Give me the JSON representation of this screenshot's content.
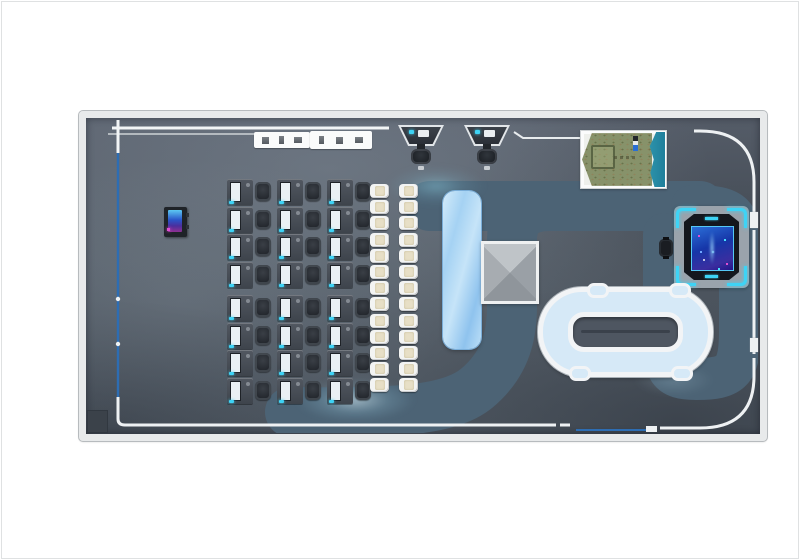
{
  "scene": {
    "title": "venue-floor-plan",
    "description": "Top-down 3D render of an e-sports / entertainment venue hall",
    "areas": {
      "workstation_zone": "rows of gaming desks with monitors and chairs",
      "seating_rows": "two columns of white chairs",
      "bar_counter": "light blue rounded counter",
      "pyramid_feature": "gray pyramid structure",
      "race_track": "white-edged mini racing track with center island",
      "game_table": "glowing interactive table on gray pad with cyan corner brackets",
      "terrain_model": "framed miniature terrain with grass field, pen and river",
      "kiosks": "two standing kiosks with stools near top wall",
      "walkway": "teal winding walkway path painted on floor"
    }
  },
  "inventory": {
    "desk_columns": 3,
    "desk_blocks_per_column": 2,
    "desks_per_block": 4,
    "total_desks": 24,
    "white_chair_columns": 2,
    "white_chairs_per_column": 13,
    "kiosk_count": 2,
    "shelf_count": 2,
    "door_tabs_right_wall": 2
  },
  "colors": {
    "wall": "#e8eaeb",
    "path": "#4c6375",
    "cyan": "#3ed3f5",
    "magenta": "#e14fd2",
    "glass": "#2d6db3",
    "trim": "#f0f3f5",
    "track_road": "#d6e9f7",
    "track_trim": "#f2f4f6",
    "island": "#4e5661",
    "stool": "#f3f4f3",
    "seat": "#e7dfc6",
    "monitor": "#eaf0f4",
    "green": "#87926a",
    "water": "#2487a3",
    "pad": "#9aa3ac"
  }
}
